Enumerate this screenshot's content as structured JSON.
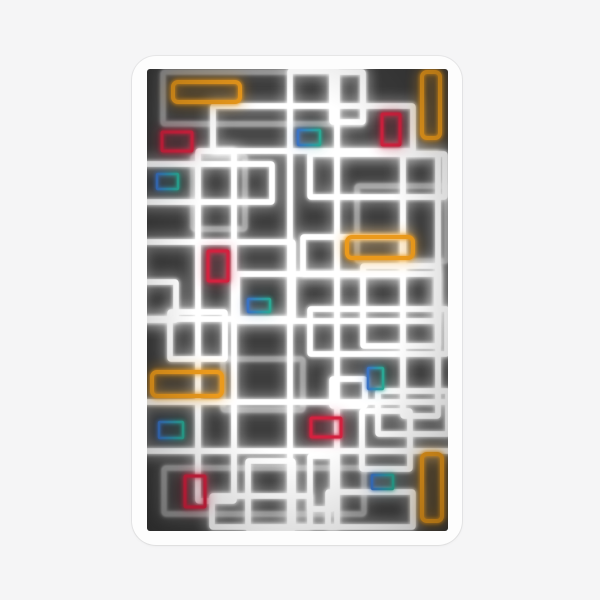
{
  "page": {
    "background": "#f5f5f6"
  },
  "sticker": {
    "shape": "rounded-rectangle",
    "background": "#fdfdfd",
    "border_color": "#e4e4e5",
    "description": "Die-cut sticker of abstract neon glowing rectangles on a dark charcoal background"
  },
  "artwork": {
    "background": "#3d3d3d",
    "styles": {
      "white": {
        "color": "#ffffff",
        "width": 5.5,
        "halo_w": 16,
        "halo_o": 0.32,
        "rx": 1
      },
      "gray": {
        "color": "#9d9d9d",
        "width": 5,
        "halo_w": 12,
        "halo_o": 0.3,
        "rx": 2,
        "soft": true
      },
      "orange": {
        "color": "#eb9a1c",
        "width": 4,
        "halo_w": 10,
        "halo_o": 0.45,
        "rx": 5
      },
      "red": {
        "color": "#d2223f",
        "width": 3,
        "halo_w": 8,
        "halo_o": 0.4,
        "rx": 1
      },
      "teal": {
        "color": "grad",
        "width": 2.5,
        "halo_w": 6,
        "halo_o": 0.35,
        "rx": 1
      }
    },
    "teal_gradient": [
      "#3a72c4",
      "#2aa893"
    ],
    "rects": [
      {
        "c": "gray",
        "x": 16,
        "y": 3,
        "w": 200,
        "h": 52
      },
      {
        "c": "gray",
        "x": 210,
        "y": 117,
        "w": 90,
        "h": 75
      },
      {
        "c": "gray",
        "x": 46,
        "y": 87,
        "w": 52,
        "h": 73
      },
      {
        "c": "gray",
        "x": 17,
        "y": 399,
        "w": 200,
        "h": 46
      },
      {
        "c": "gray",
        "x": 76,
        "y": 290,
        "w": 80,
        "h": 51
      },
      {
        "c": "white",
        "x": 66,
        "y": 37,
        "w": 200,
        "h": 45
      },
      {
        "c": "white",
        "x": 163,
        "y": 85,
        "w": 135,
        "h": 43
      },
      {
        "c": "white",
        "x": -17,
        "y": 95,
        "w": 142,
        "h": 38
      },
      {
        "c": "white",
        "x": 51,
        "y": 82,
        "w": 36,
        "h": 350
      },
      {
        "c": "white",
        "x": 90,
        "y": 205,
        "w": 200,
        "h": 47
      },
      {
        "c": "white",
        "x": -19,
        "y": 213,
        "w": 48,
        "h": 38
      },
      {
        "c": "white",
        "x": 23,
        "y": 243,
        "w": 55,
        "h": 47
      },
      {
        "c": "white",
        "x": 143,
        "y": 2,
        "w": 47,
        "h": 456
      },
      {
        "c": "white",
        "x": 256,
        "y": 85,
        "w": 35,
        "h": 262
      },
      {
        "c": "white",
        "x": 216,
        "y": 197,
        "w": 75,
        "h": 80
      },
      {
        "c": "white",
        "x": 215,
        "y": 342,
        "w": 48,
        "h": 58
      },
      {
        "c": "white",
        "x": 231,
        "y": 322,
        "w": 70,
        "h": 43
      },
      {
        "c": "white",
        "x": 185,
        "y": 310,
        "w": 33,
        "h": 27
      },
      {
        "c": "white",
        "x": 163,
        "y": 387,
        "w": 23,
        "h": 53
      },
      {
        "c": "white",
        "x": 181,
        "y": 423,
        "w": 85,
        "h": 35
      },
      {
        "c": "white",
        "x": 65,
        "y": 427,
        "w": 98,
        "h": 31
      },
      {
        "c": "white",
        "x": -7,
        "y": 333,
        "w": 315,
        "h": 49
      },
      {
        "c": "white",
        "x": 163,
        "y": 240,
        "w": 137,
        "h": 45
      },
      {
        "c": "white",
        "x": 185,
        "y": 3,
        "w": 31,
        "h": 50
      },
      {
        "c": "white",
        "x": 101,
        "y": 392,
        "w": 45,
        "h": 68
      },
      {
        "c": "white",
        "x": -7,
        "y": 173,
        "w": 153,
        "h": 77
      },
      {
        "c": "white",
        "x": 156,
        "y": 168,
        "w": 100,
        "h": 37
      },
      {
        "c": "orange",
        "x": 26,
        "y": 13,
        "w": 67,
        "h": 20
      },
      {
        "c": "orange",
        "x": 275,
        "y": 3,
        "w": 18,
        "h": 66
      },
      {
        "c": "orange",
        "x": 200,
        "y": 168,
        "w": 66,
        "h": 21
      },
      {
        "c": "orange",
        "x": 5,
        "y": 303,
        "w": 70,
        "h": 24
      },
      {
        "c": "orange",
        "x": 275,
        "y": 385,
        "w": 20,
        "h": 67
      },
      {
        "c": "red",
        "x": 15,
        "y": 63,
        "w": 30,
        "h": 19
      },
      {
        "c": "red",
        "x": 235,
        "y": 45,
        "w": 18,
        "h": 31
      },
      {
        "c": "red",
        "x": 61,
        "y": 182,
        "w": 20,
        "h": 30
      },
      {
        "c": "red",
        "x": 164,
        "y": 349,
        "w": 30,
        "h": 19
      },
      {
        "c": "red",
        "x": 38,
        "y": 407,
        "w": 20,
        "h": 31
      },
      {
        "c": "teal",
        "x": 151,
        "y": 61,
        "w": 22,
        "h": 15
      },
      {
        "c": "teal",
        "x": 10,
        "y": 105,
        "w": 21,
        "h": 15
      },
      {
        "c": "teal",
        "x": 101,
        "y": 230,
        "w": 22,
        "h": 13
      },
      {
        "c": "teal",
        "x": 221,
        "y": 299,
        "w": 15,
        "h": 21
      },
      {
        "c": "teal",
        "x": 12,
        "y": 353,
        "w": 24,
        "h": 16
      },
      {
        "c": "teal",
        "x": 225,
        "y": 406,
        "w": 21,
        "h": 14
      }
    ]
  }
}
